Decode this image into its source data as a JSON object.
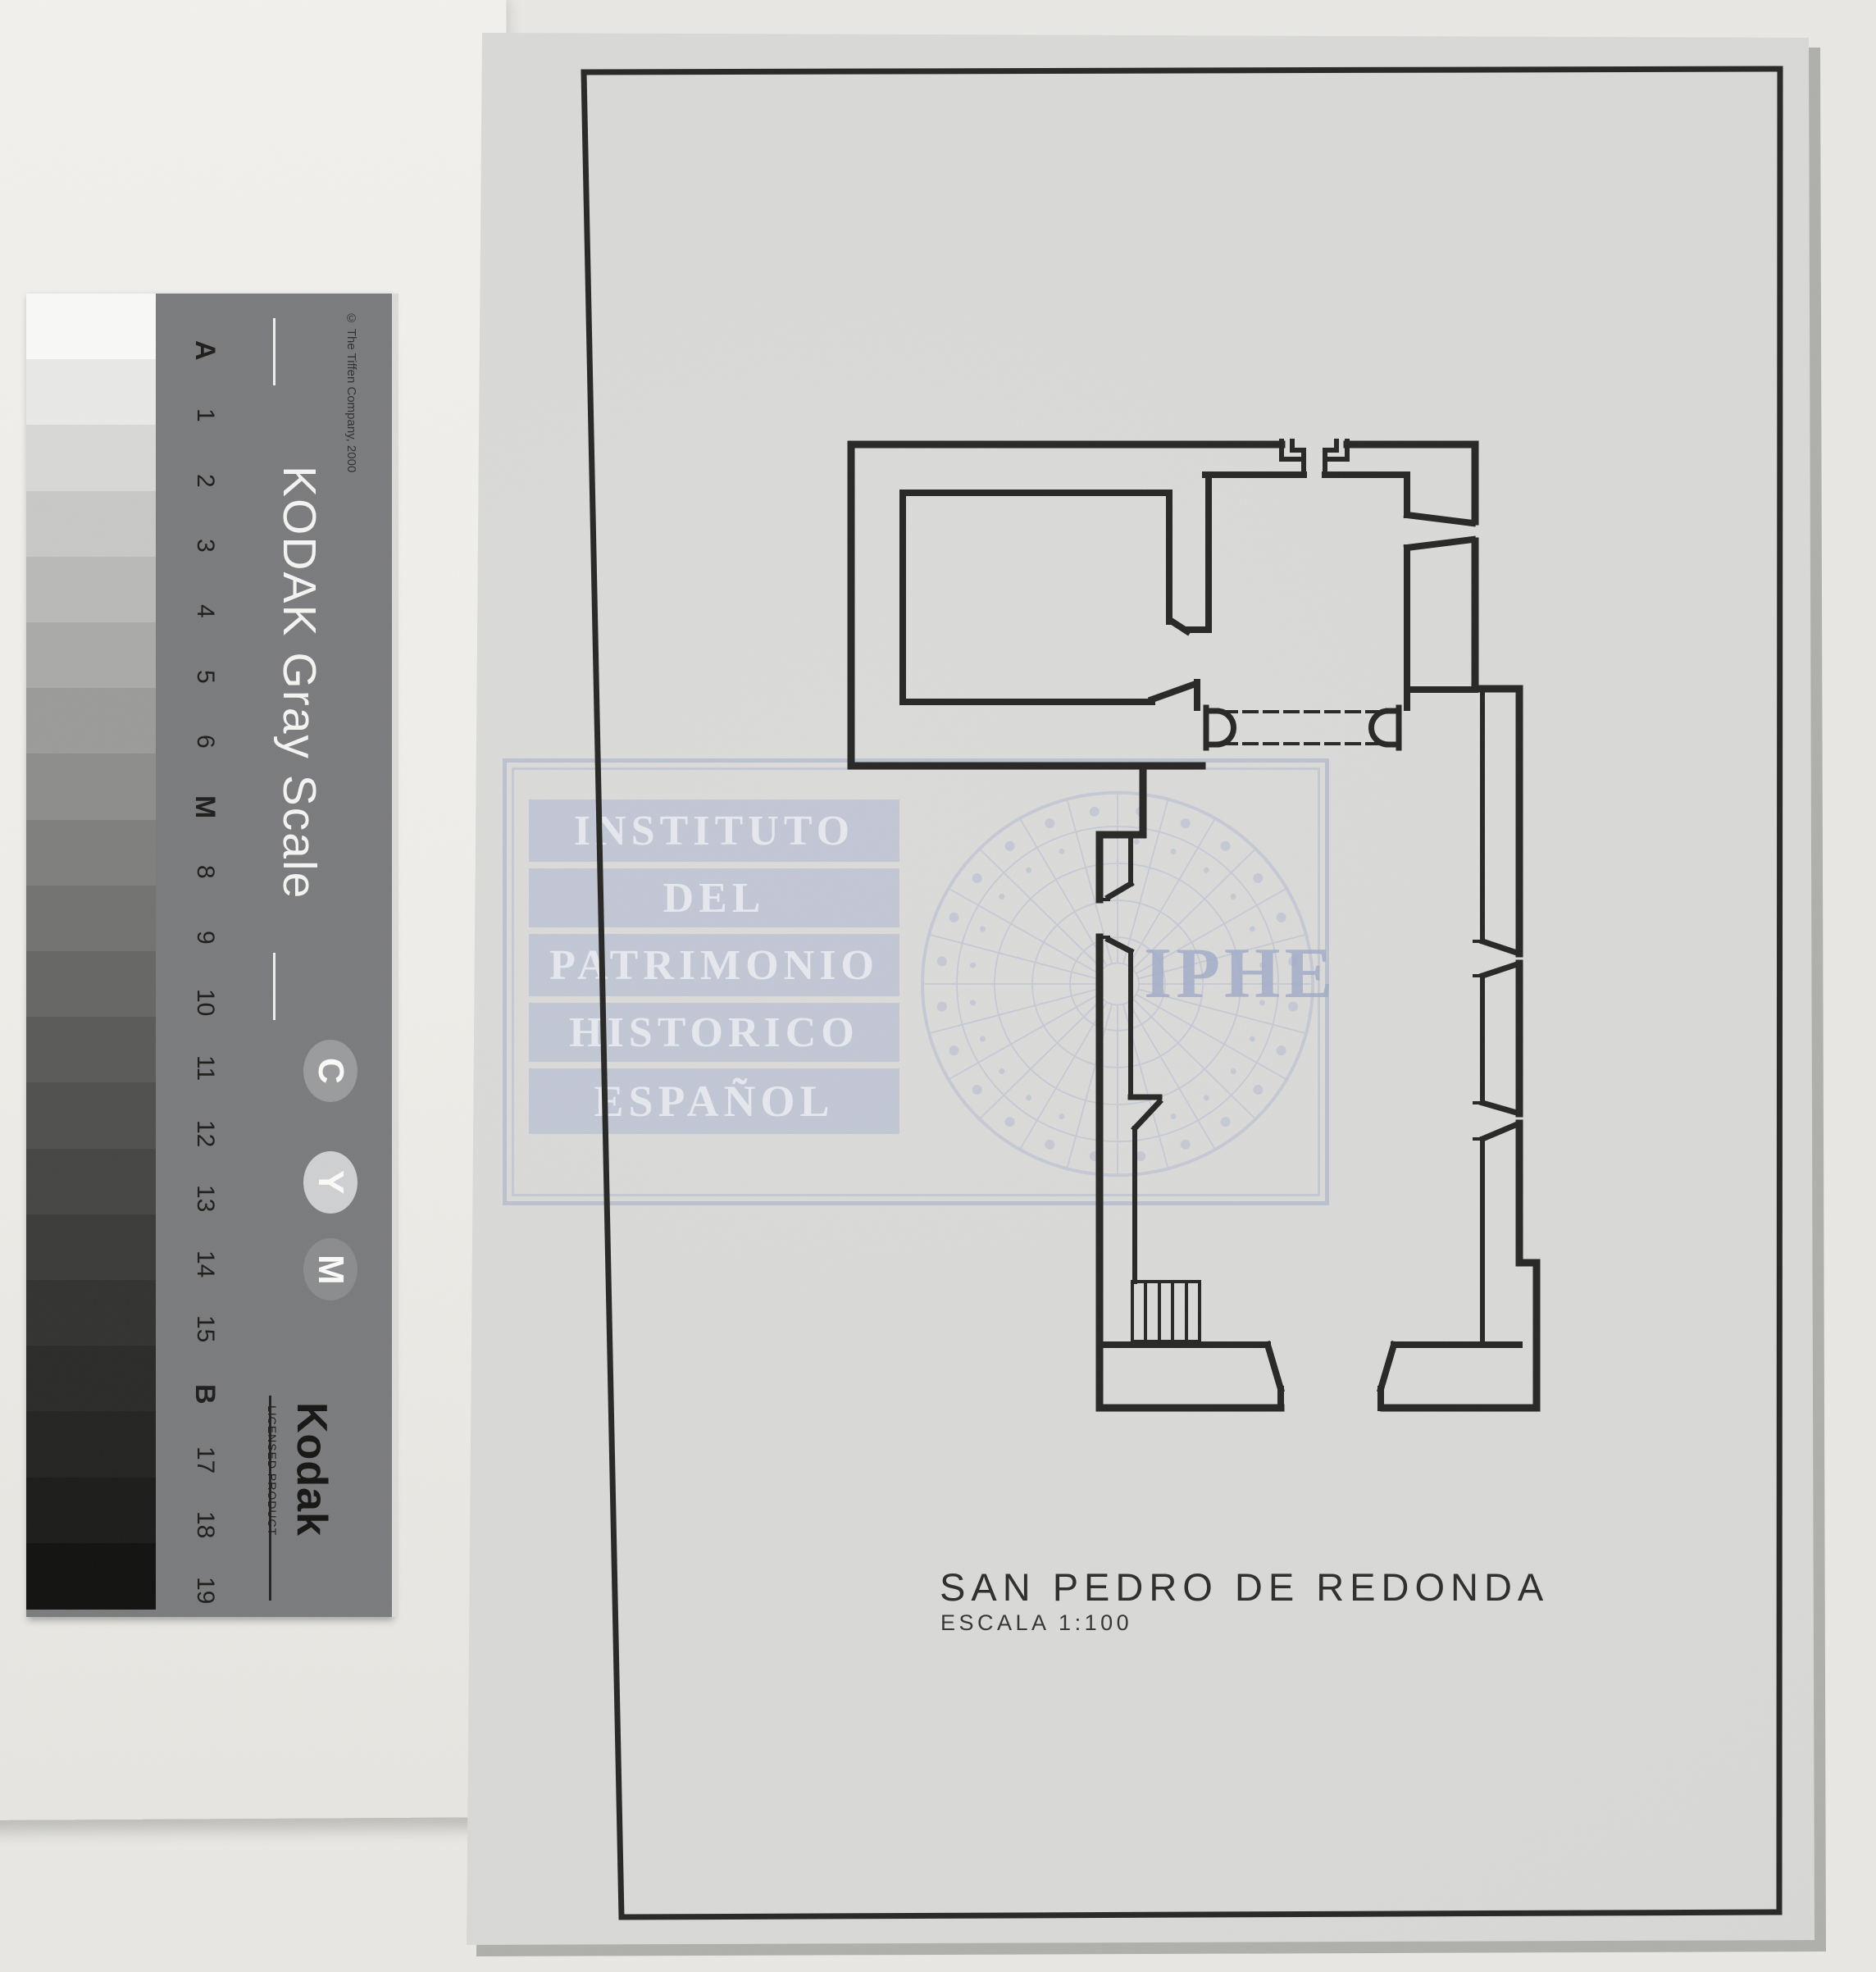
{
  "plan": {
    "title": "SAN PEDRO DE REDONDA",
    "scale_label": "ESCALA 1:100"
  },
  "watermark": {
    "lines": [
      "INSTITUTO",
      "DEL",
      "PATRIMONIO",
      "HISTORICO",
      "ESPAÑOL"
    ],
    "acronym": "IPHE",
    "color": "#a9b3cf"
  },
  "gray_scale_card": {
    "title": "KODAK Gray Scale",
    "copyright": "© The Tiffen Company, 2000",
    "step_labels": [
      "A",
      "1",
      "2",
      "3",
      "4",
      "5",
      "6",
      "M",
      "8",
      "9",
      "10",
      "11",
      "12",
      "13",
      "14",
      "15",
      "B",
      "17",
      "18",
      "19"
    ],
    "bold_labels": [
      "A",
      "M",
      "B"
    ],
    "channel_letters": [
      "C",
      "Y",
      "M"
    ],
    "channel_backgrounds": [
      "#9a9b9d",
      "#cfd0d2",
      "#8b8c8e"
    ],
    "brand": "Kodak",
    "licensed_text": "LICENSED PRODUCT",
    "patch_shades": [
      "#f9f9f7",
      "#e9e9e7",
      "#d8d8d6",
      "#c8c8c6",
      "#b9b9b7",
      "#aaaaa8",
      "#9b9b99",
      "#8d8d8b",
      "#7f7f7d",
      "#727270",
      "#666664",
      "#5a5a58",
      "#4f4f4d",
      "#454543",
      "#3b3b39",
      "#323230",
      "#2a2a28",
      "#232321",
      "#1b1b1a",
      "#111110"
    ]
  },
  "colors": {
    "paper": "#dadad8",
    "ink": "#272725",
    "background": "#e9e8e5",
    "card_background": "#7a7b7d"
  }
}
